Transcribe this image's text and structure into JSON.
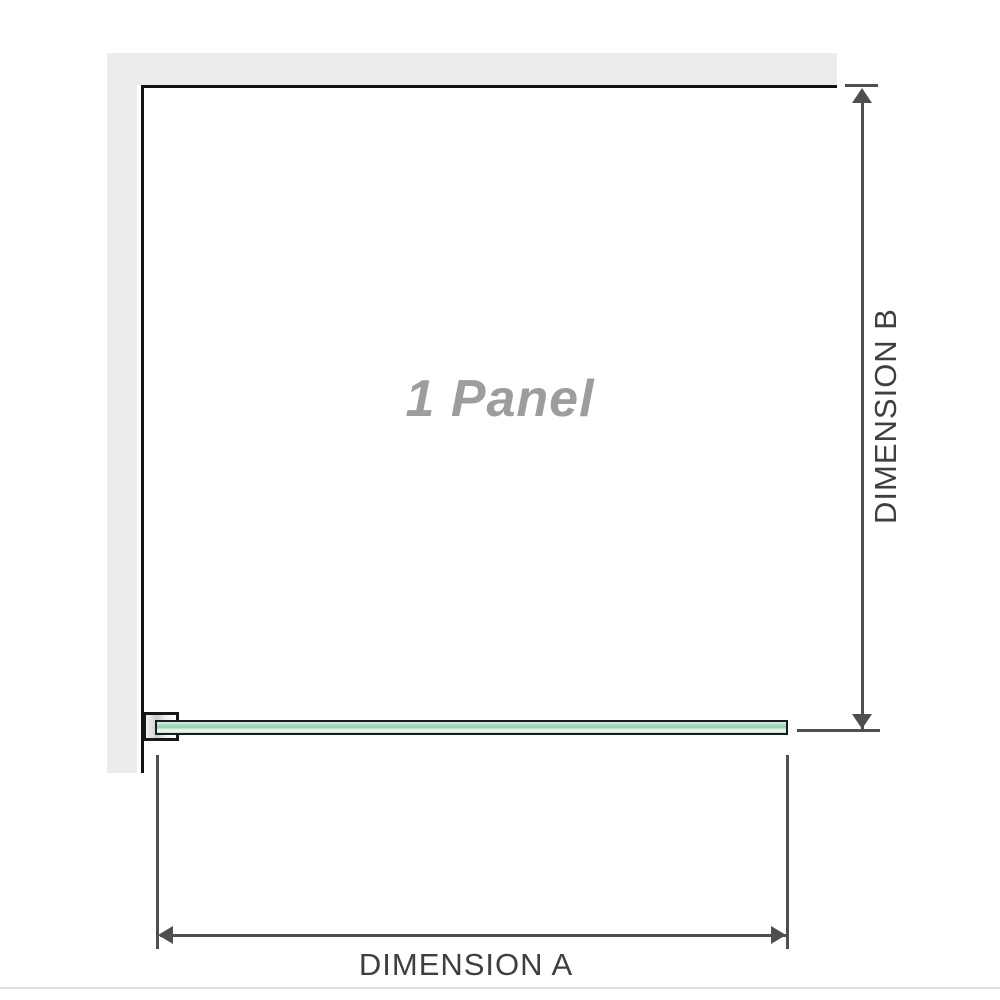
{
  "diagram": {
    "panel_label": "1 Panel",
    "dimension_a_label": "DIMENSION A",
    "dimension_b_label": "DIMENSION B"
  },
  "icons": {
    "arrow_up": "css-triangle-up",
    "arrow_down": "css-triangle-down",
    "arrow_left": "css-triangle-left",
    "arrow_right": "css-triangle-right"
  },
  "colors": {
    "wall": "#ececec",
    "outline": "#121212",
    "dimension_line": "#4f4f4f",
    "dimension_text": "#3f3f3f",
    "panel_text": "#9d9d9d",
    "glass_border": "#1b1b1b",
    "glass_light": "#d9efe3",
    "glass_mid": "#8fcfaa",
    "glass_highlight": "#f1faf4",
    "bracket_fill": "#cccccc",
    "divider": "#dfdfdc"
  }
}
